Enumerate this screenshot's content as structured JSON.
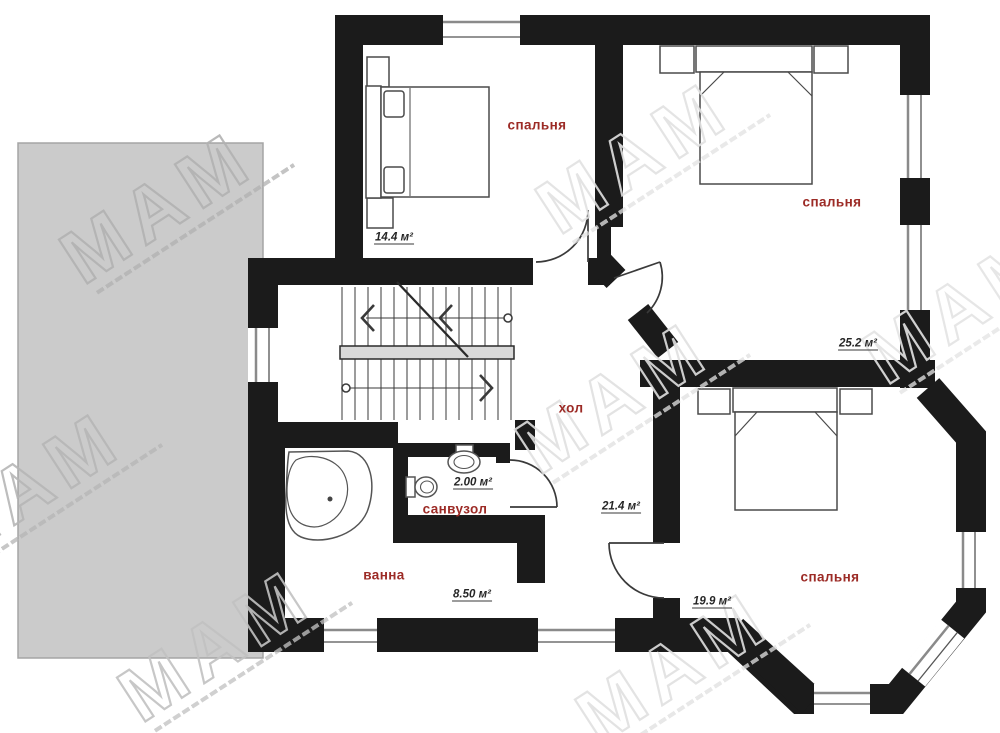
{
  "watermark": {
    "text": "МАМ"
  },
  "rooms": {
    "bedroom1": {
      "name": "спальня",
      "area": "14.4 м²"
    },
    "bedroom2": {
      "name": "спальня",
      "area": "25.2 м²"
    },
    "bedroom3": {
      "name": "спальня",
      "area": "19.9 м²"
    },
    "hall": {
      "name": "хол",
      "area": "21.4 м²"
    },
    "bath": {
      "name": "ванна",
      "area": "8.50 м²"
    },
    "wc": {
      "name": "санвузол",
      "area": "2.00 м²"
    }
  },
  "colors": {
    "wall": "#1b1b1b",
    "room_label": "#9c2b26",
    "area_label": "#262626",
    "terrace": "#cbcbcb",
    "stair_landing": "#d9d9d9",
    "watermark_light": "#e0e0e0",
    "watermark_dark": "#b2b2b2"
  }
}
